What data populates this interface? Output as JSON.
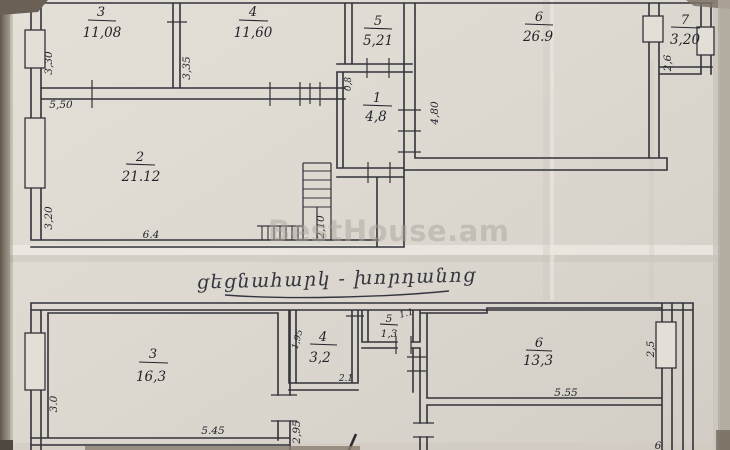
{
  "watermark": "BestHouse.am",
  "caption": "ցեցնահարկ - խորդանոց",
  "upper_plan": {
    "title": "upper floor plan",
    "rooms": [
      {
        "number": "3",
        "area": "11,08"
      },
      {
        "number": "4",
        "area": "11,60"
      },
      {
        "number": "5",
        "area": "5,21"
      },
      {
        "number": "6",
        "area": "26.9"
      },
      {
        "number": "7",
        "area": "3,20"
      },
      {
        "number": "1",
        "area": "4,8"
      },
      {
        "number": "2",
        "area": "21.12"
      }
    ],
    "dimensions": [
      {
        "text": "3,30"
      },
      {
        "text": "5,50"
      },
      {
        "text": "3,35"
      },
      {
        "text": "3,20"
      },
      {
        "text": "6.4"
      },
      {
        "text": "2,10"
      },
      {
        "text": "0,8"
      },
      {
        "text": "4,80"
      },
      {
        "text": "2,6"
      }
    ]
  },
  "lower_plan": {
    "title": "lower floor plan",
    "rooms": [
      {
        "number": "3",
        "area": "16,3"
      },
      {
        "number": "4",
        "area": "3,2"
      },
      {
        "number": "5",
        "area": "1,3"
      },
      {
        "number": "6",
        "area": "13,3"
      }
    ],
    "dimensions": [
      {
        "text": "3.0"
      },
      {
        "text": "5.45"
      },
      {
        "text": "2,95"
      },
      {
        "text": "1,95"
      },
      {
        "text": "2.1"
      },
      {
        "text": "1.1"
      },
      {
        "text": "5.55"
      },
      {
        "text": "2,5"
      },
      {
        "text": "6"
      }
    ]
  }
}
